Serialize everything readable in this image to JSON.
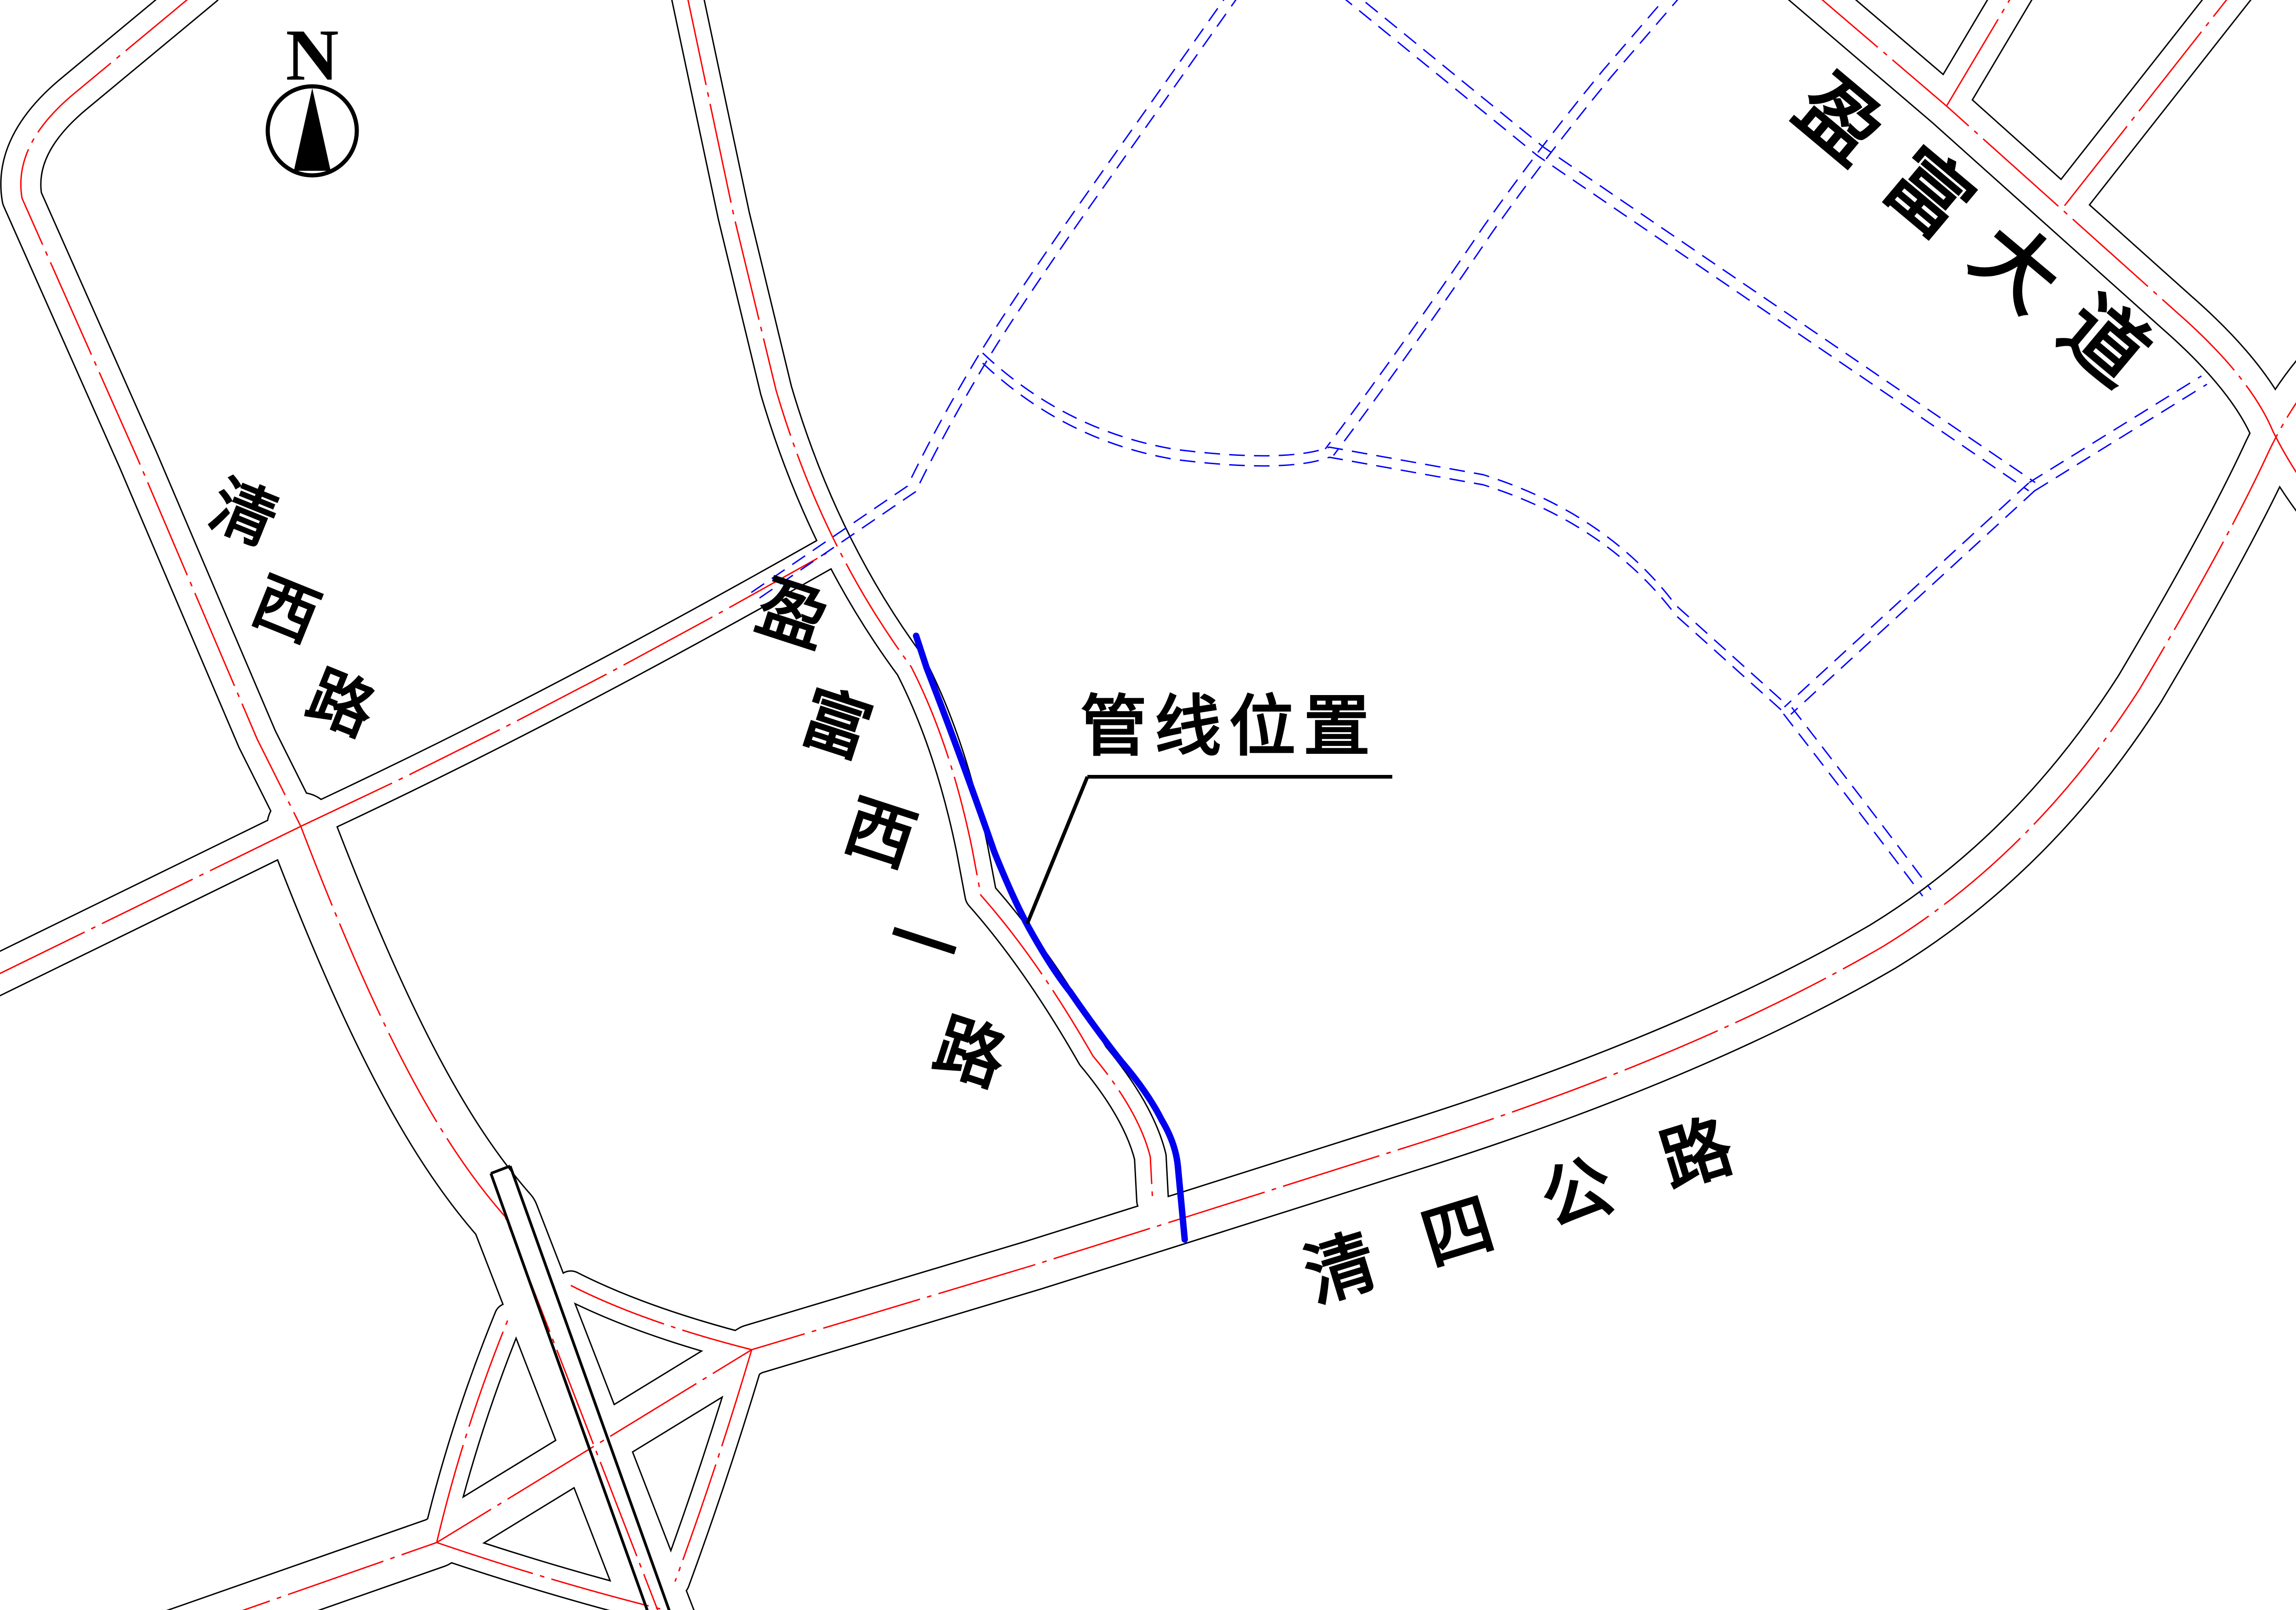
{
  "drawing": {
    "title": "管线位置示意图",
    "type": "pipeline-location-plan",
    "compass": {
      "letter": "N"
    },
    "colors": {
      "road_edge": "#000000",
      "centerline": "#ff0000",
      "planned_road": "#0000ff",
      "pipeline": "#0000ee",
      "background": "#ffffff",
      "text": "#000000"
    },
    "roads": [
      {
        "id": "qingxi",
        "name": "清西路",
        "style": "existing"
      },
      {
        "id": "yingfu_west1",
        "name": "盈富西一路",
        "style": "existing"
      },
      {
        "id": "yingfu_ave",
        "name": "盈富大道",
        "style": "existing"
      },
      {
        "id": "qingsi",
        "name": "清四公路",
        "style": "existing"
      }
    ],
    "planned_roads_note": "蓝色虚线为规划道路",
    "pipeline": {
      "label": "管线位置",
      "color": "#0000ee"
    }
  }
}
